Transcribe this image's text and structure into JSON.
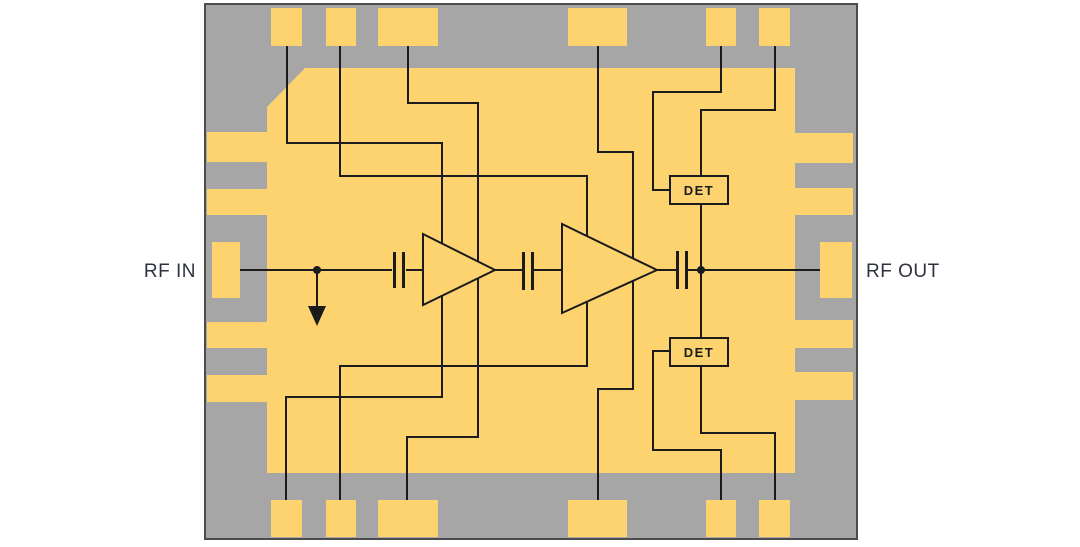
{
  "diagram": {
    "type": "rf-amplifier-functional-block-diagram",
    "labels": {
      "rf_in": "RF IN",
      "rf_out": "RF OUT",
      "detector1": "DET",
      "detector2": "DET"
    },
    "colors": {
      "background": "#ffffff",
      "substrate": "#a6a6a6",
      "metal": "#fcd36e",
      "trace": "#1b1b1b",
      "chip_border": "#4c4c4c",
      "label_text": "#2e3140"
    }
  }
}
